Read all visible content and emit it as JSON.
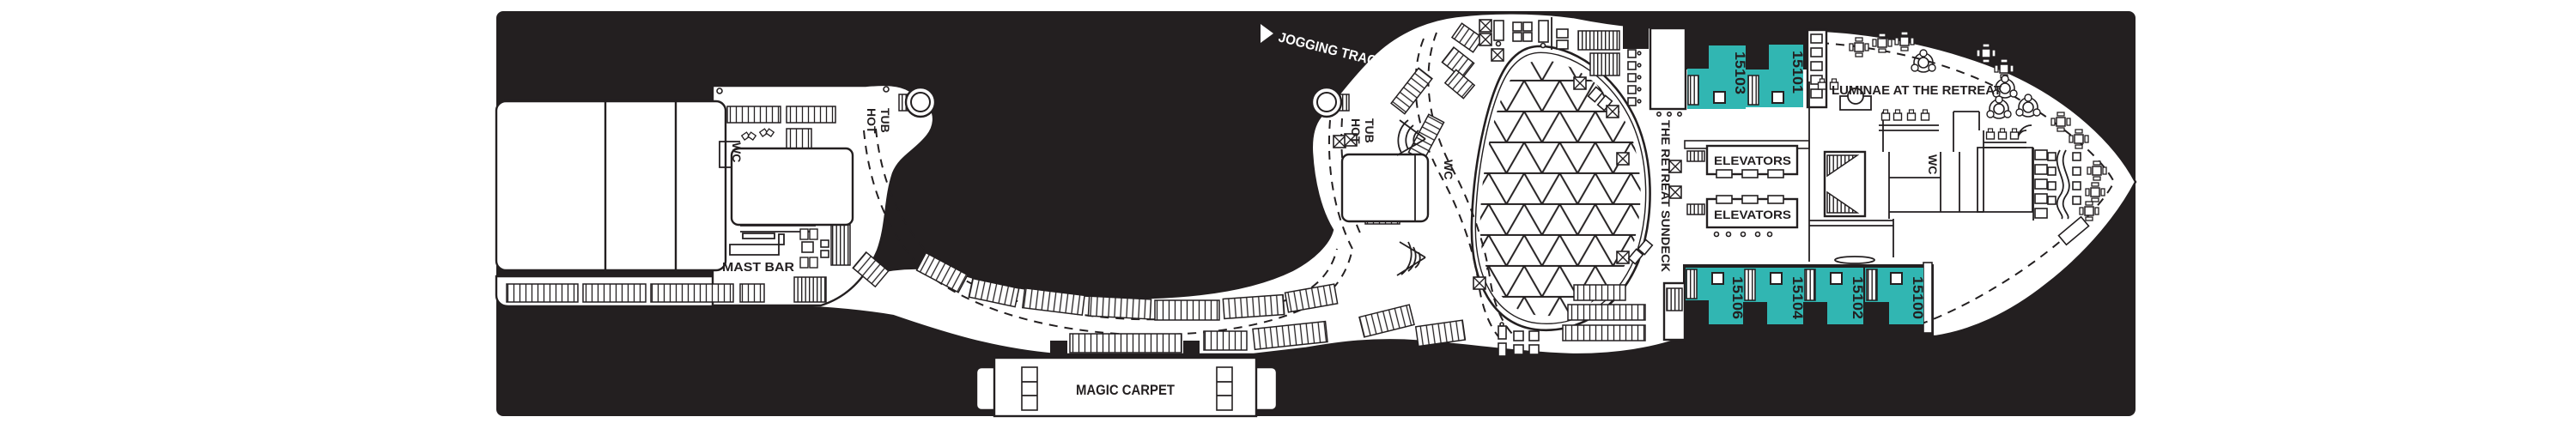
{
  "deck_plan": {
    "labels": {
      "jogging_track": "JOGGING TRACK",
      "hot": "HOT",
      "tub": "TUB",
      "wc": "WC",
      "mast_bar": "MAST BAR",
      "magic_carpet": "MAGIC CARPET",
      "retreat_sundeck": "THE RETREAT SUNDECK",
      "luminae": "LUMINAE AT THE RETREAT",
      "elevators": "ELEVATORS"
    },
    "cabins": {
      "top": [
        {
          "number": "15103"
        },
        {
          "number": "15101"
        }
      ],
      "bottom": [
        {
          "number": "15106"
        },
        {
          "number": "15104"
        },
        {
          "number": "15102"
        },
        {
          "number": "15100"
        }
      ]
    },
    "colors": {
      "panel": "#231f20",
      "deck": "#ffffff",
      "line": "#231f20",
      "cabin": "#31b6b2",
      "track_label": "#ffffff"
    }
  }
}
